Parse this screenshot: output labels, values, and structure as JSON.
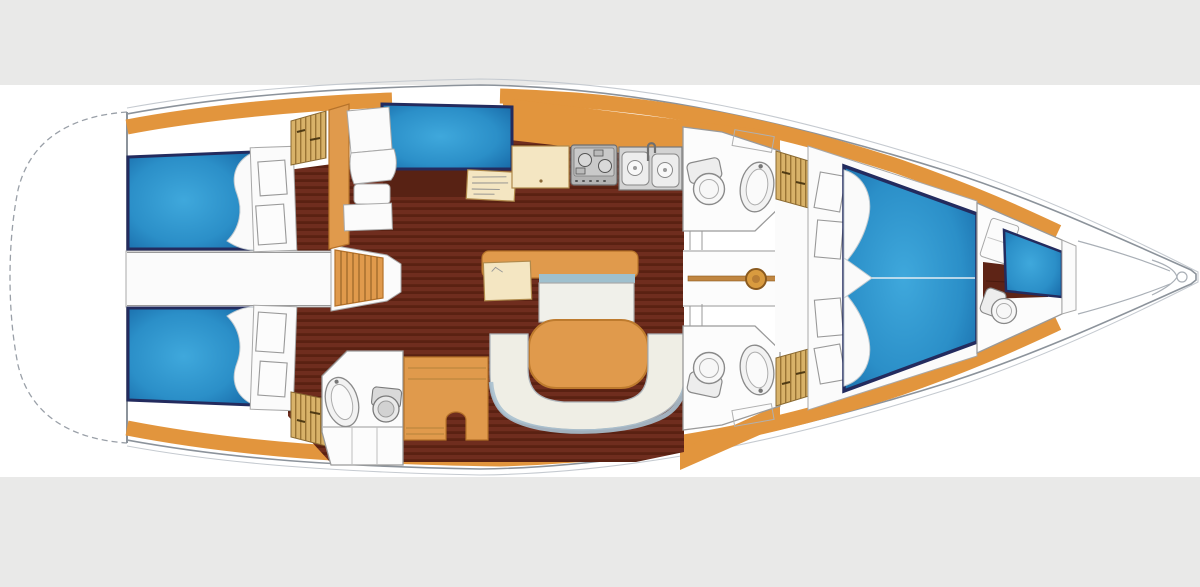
{
  "canvas": {
    "width": 1200,
    "height": 587
  },
  "bands": {
    "top_height": 85,
    "bottom_start": 477
  },
  "palette": {
    "band": "#E9E9E8",
    "hull_outline": "#8C939B",
    "trim_wood": "#E2953D",
    "floor_dark": "#6F2D1E",
    "floor_stripe": "#5A2112",
    "berth_blue_light": "#3FA8DC",
    "berth_blue_mid": "#2B8FC8",
    "berth_blue_dark": "#13609F",
    "berth_border_navy": "#232B5E",
    "furniture_wood": "#E09A4C",
    "cream": "#F4E6C2",
    "settee": "#EFEEE5",
    "settee_trim": "#9FC0CE",
    "locker_tan": "#D8B269",
    "white_room": "#FCFCFC",
    "fixture_gray": "#8A8A8A"
  },
  "components": [
    {
      "id": "stern-swim-platform",
      "kind": "hull"
    },
    {
      "id": "hull-outline",
      "kind": "hull"
    },
    {
      "id": "hull-trim",
      "kind": "woodwork"
    },
    {
      "id": "cabin-sole",
      "kind": "floor"
    },
    {
      "id": "aft-port-cabin",
      "kind": "cabin",
      "features": [
        "double-berth",
        "pillow",
        "lockers",
        "hanging-locker"
      ]
    },
    {
      "id": "aft-starboard-cabin",
      "kind": "cabin",
      "features": [
        "double-berth",
        "pillow",
        "lockers",
        "hanging-locker"
      ]
    },
    {
      "id": "aft-walkway",
      "kind": "passage"
    },
    {
      "id": "companionway-steps",
      "kind": "stairs"
    },
    {
      "id": "nav-station",
      "kind": "furniture",
      "features": [
        "seat",
        "berth-panel",
        "chart-table",
        "partition"
      ]
    },
    {
      "id": "galley",
      "kind": "furniture",
      "features": [
        "counter",
        "stove",
        "double-sink",
        "faucet"
      ]
    },
    {
      "id": "port-head",
      "kind": "bathroom",
      "features": [
        "toilet",
        "basin",
        "cabinet"
      ]
    },
    {
      "id": "starboard-aft-head",
      "kind": "bathroom",
      "features": [
        "basin",
        "toilet",
        "vanity"
      ]
    },
    {
      "id": "starboard-forward-head",
      "kind": "bathroom",
      "features": [
        "toilet",
        "basin",
        "cabinet"
      ]
    },
    {
      "id": "saloon",
      "kind": "furniture",
      "features": [
        "sideboard-table",
        "table-leaf",
        "bench-seat",
        "oval-table",
        "u-settee",
        "dresser-steps"
      ]
    },
    {
      "id": "corridor",
      "kind": "passage",
      "features": [
        "keel-beam",
        "mast"
      ]
    },
    {
      "id": "forward-cabin",
      "kind": "cabin",
      "features": [
        "v-berth",
        "pillows",
        "lockers"
      ]
    },
    {
      "id": "forepeak-cabin",
      "kind": "cabin",
      "features": [
        "berth",
        "seat",
        "toilet"
      ]
    },
    {
      "id": "bow-anchor-locker",
      "kind": "hull",
      "features": [
        "locker-lines",
        "bow-fitting"
      ]
    }
  ]
}
